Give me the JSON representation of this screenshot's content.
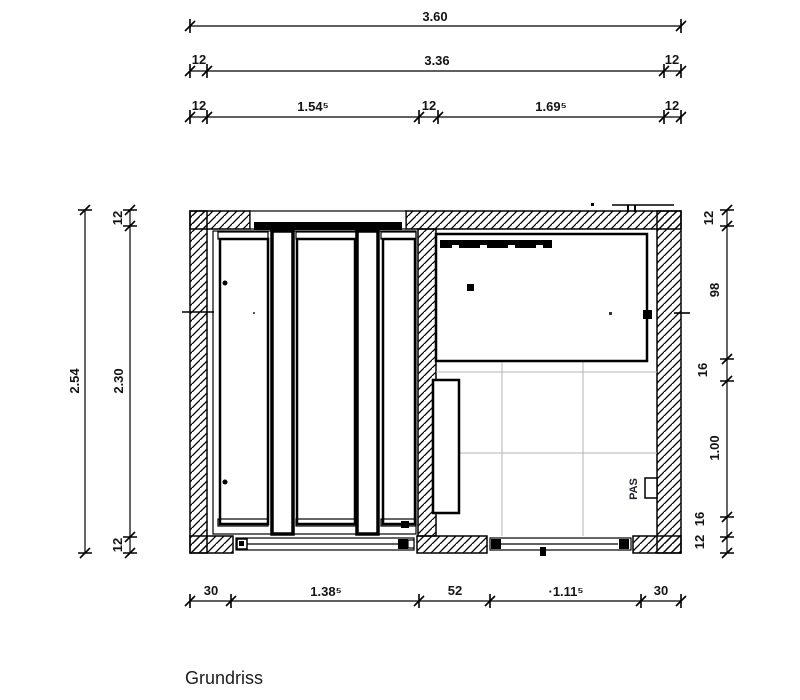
{
  "title": "Grundriss",
  "plan": {
    "socket_label": "PAS"
  },
  "dimensions": {
    "top": {
      "total": "3.60",
      "row2": [
        "12",
        "3.36",
        "12"
      ],
      "row3": [
        "12",
        "1.54⁵",
        "12",
        "1.69⁵",
        "12"
      ]
    },
    "bottom": [
      "30",
      "1.38⁵",
      "52",
      "·1.11⁵",
      "30"
    ],
    "left": {
      "outer": "2.54",
      "inner": [
        "12",
        "2.30",
        "12"
      ]
    },
    "right": [
      "12",
      "98",
      "16",
      "1.00",
      "16",
      "12"
    ]
  }
}
